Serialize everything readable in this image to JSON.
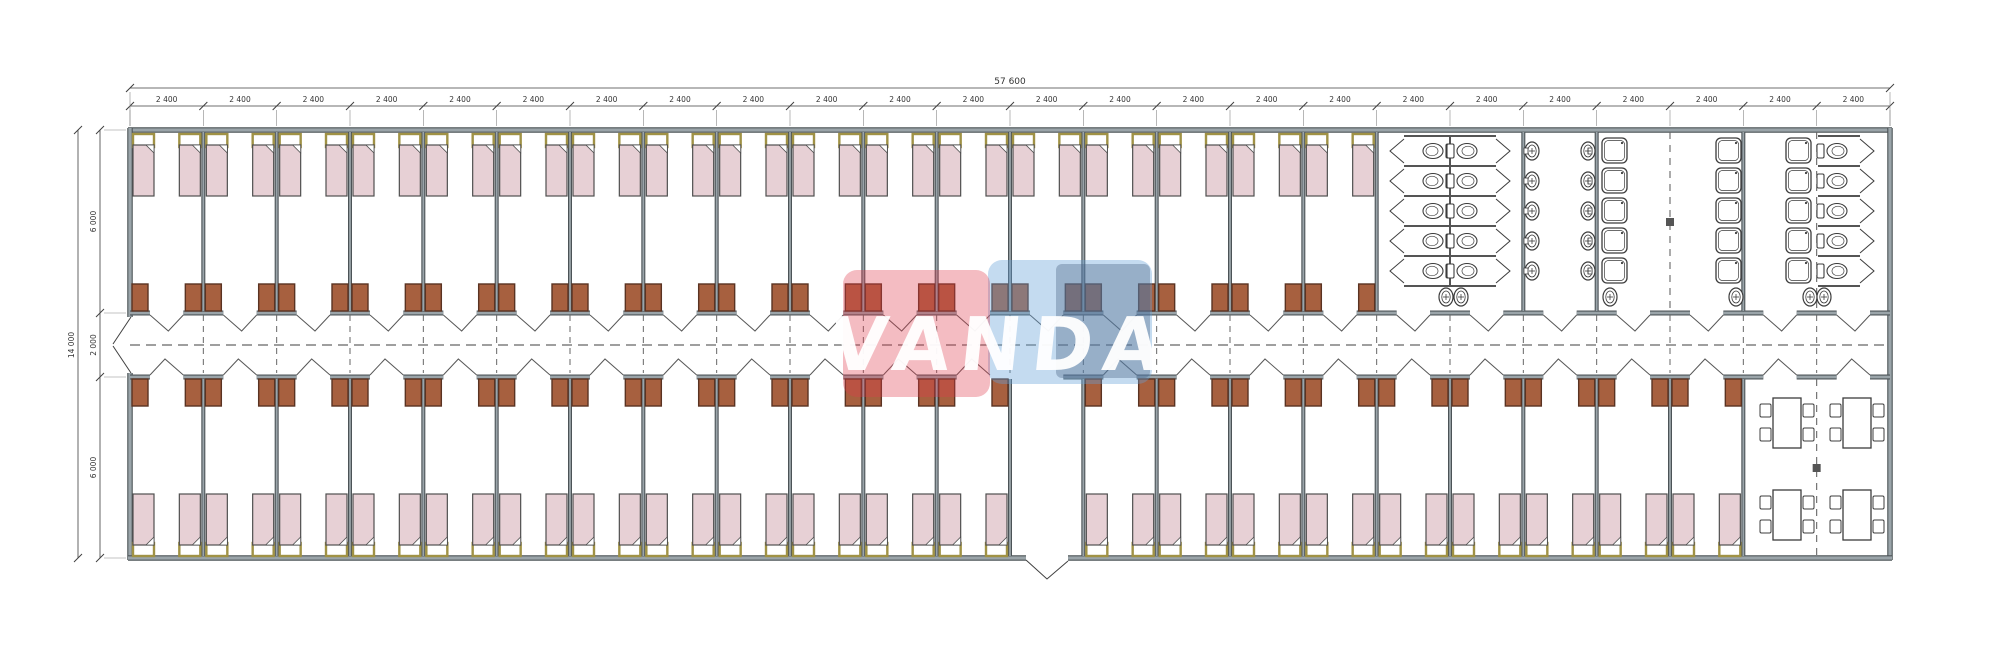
{
  "drawing": {
    "title": "dormitory-floor-plan",
    "watermark": {
      "text": "VANDA"
    },
    "dimensions_top": {
      "overall": "57 600",
      "module": "2 400",
      "module_count": 24
    },
    "dimensions_left": {
      "overall": "14 000",
      "segments": [
        "6 000",
        "2 000",
        "6 000"
      ]
    },
    "layout": {
      "top_bedrooms": 17,
      "bottom_bedrooms": 22,
      "beds_per_room": 2,
      "entrance_module_index": 12,
      "sanitary": {
        "toilet_stall_rows": 5,
        "sink_rows_washroom": 5,
        "shower_rows_per_column": 5,
        "shower_columns": 3,
        "end_toilet_rows": 5
      },
      "dining": {
        "tables": 4,
        "chairs_per_table": 4
      }
    },
    "colors": {
      "wall_dark": "#4c5357",
      "wall_light": "#9aa4a9",
      "partition_dark": "#555d61",
      "partition_light": "#a2abb0",
      "bed_fill": "#e7d0d5",
      "bed_stroke": "#4f4f4f",
      "pillow_stroke": "#a09245",
      "pillow_fill": "#ffffff",
      "wardrobe_fill": "#a7603f",
      "wardrobe_stroke": "#5a3322",
      "fixture_stroke": "#3c3c3c",
      "fixture_fill": "#ffffff",
      "dash": "#666666",
      "dim_line": "#3f3f3f",
      "dim_text": "#333333",
      "logo_red": "rgba(224,60,75,0.34)",
      "logo_blue": "rgba(100,160,215,0.38)",
      "logo_slate": "rgba(72,96,130,0.36)",
      "logo_text": "rgba(255,255,255,0.95)"
    }
  }
}
